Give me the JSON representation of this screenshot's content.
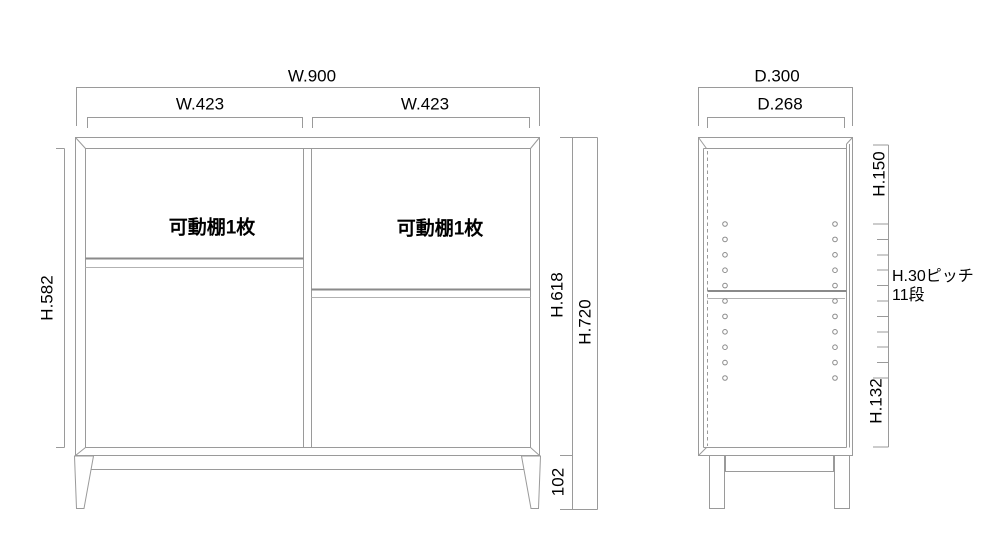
{
  "diagram_title": "cabinet dimension drawing",
  "colors": {
    "background": "#ffffff",
    "line": "#9a9a9a",
    "shelf_line": "#8a8a8a",
    "text": "#000000"
  },
  "front_view": {
    "dims": {
      "total_width": "W.900",
      "left_bay_width": "W.423",
      "right_bay_width": "W.423",
      "interior_height": "H.582",
      "body_height": "H.618",
      "total_height": "H.720",
      "leg_height": "102"
    },
    "labels": {
      "left_bay_shelf": "可動棚1枚",
      "right_bay_shelf": "可動棚1枚"
    }
  },
  "side_view": {
    "dims": {
      "total_depth": "D.300",
      "interior_depth": "D.268",
      "top_offset": "H.150",
      "bottom_offset": "H.132"
    },
    "labels": {
      "pitch_line1": "H.30ピッチ",
      "pitch_line2": "11段"
    }
  }
}
